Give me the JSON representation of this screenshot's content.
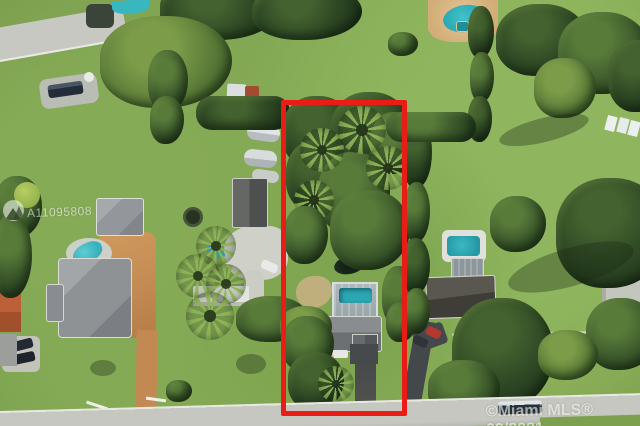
{
  "photo": {
    "description": "Aerial drone view of suburban lots; subject property outlined in red with house, caged pool, pond and dense trees",
    "orientation": "top-down"
  },
  "watermarks": {
    "listing_id": "A11095808",
    "attribution": "©Miami MLS® 09/2021"
  },
  "highlight": {
    "name": "property-boundary",
    "color": "#ea1c16"
  },
  "colors": {
    "grass": "#83a854",
    "tree_canopy": "#3d5a2c",
    "pool_teal": "#2fb3bd",
    "street_gray": "#c6c7c0",
    "paver_orange": "#c28a52",
    "asphalt": "#474a4c",
    "roof_gray": "#8f9295",
    "roof_dark_brown": "#4d4a44"
  }
}
